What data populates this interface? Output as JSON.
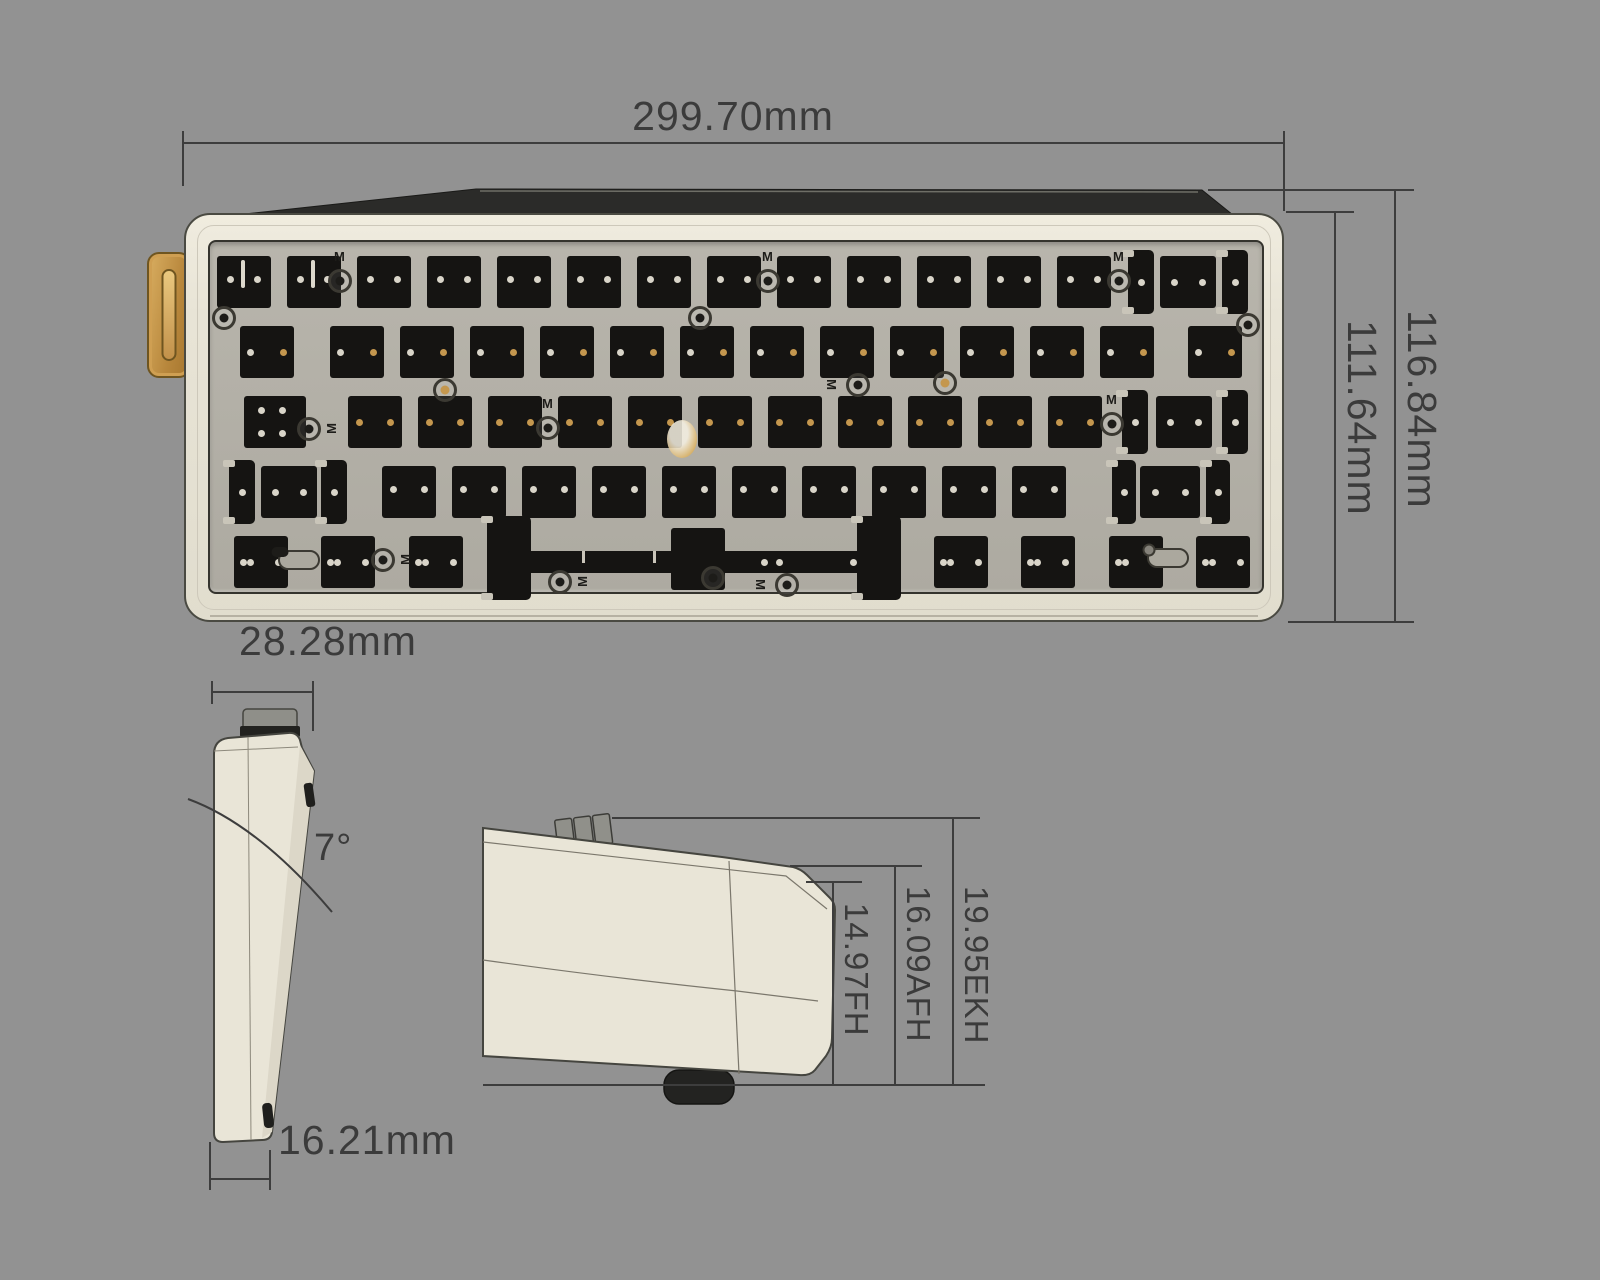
{
  "drawing": {
    "subject": "mechanical keyboard barebones kit dimension drawing",
    "views": [
      "top view",
      "side profile view",
      "front view"
    ]
  },
  "dimensions": {
    "top_width": "299.70mm",
    "case_depth_outer": "116.84mm",
    "case_depth_inner": "111.64mm",
    "side_top_depth": "28.28mm",
    "typing_angle": "7°",
    "side_front_height": "16.21mm",
    "front_height_fh": "14.97FH",
    "front_height_afh": "16.09AFH",
    "front_height_ekh": "19.95EKH"
  },
  "colors": {
    "background": "#929292",
    "case": "#e8e4d6",
    "plate": "#b2afa6",
    "cutout": "#151412",
    "accent_gold": "#c4974e",
    "line": "#3d3d3d",
    "text": "#3b3b3b"
  },
  "keyboard_layout": {
    "rows": [
      {
        "name": "r1",
        "y": 256,
        "h": 52,
        "dots": "r1",
        "plain": {
          "w": 54,
          "xs": [
            217,
            287,
            357,
            427,
            497,
            567,
            637,
            707,
            777,
            847,
            917,
            987,
            1057
          ]
        },
        "complex": [
          {
            "wings": [
              [
                1128,
                26
              ],
              [
                1222,
                26
              ]
            ],
            "sq": [
              1160,
              56
            ]
          }
        ]
      },
      {
        "name": "r2",
        "y": 326,
        "h": 52,
        "dots": "r2",
        "plain": {
          "w": 54,
          "xs": [
            240,
            330,
            400,
            470,
            540,
            610,
            680,
            750,
            820,
            890,
            960,
            1030,
            1100,
            1188
          ]
        }
      },
      {
        "name": "r3",
        "y": 396,
        "h": 52,
        "dots": "r3",
        "caps": {
          "x": 244,
          "w": 62
        },
        "plain": {
          "w": 54,
          "xs": [
            348,
            418,
            488,
            558,
            628,
            698,
            768,
            838,
            908,
            978,
            1048
          ]
        },
        "complex": [
          {
            "wings": [
              [
                1122,
                26
              ],
              [
                1222,
                26
              ]
            ],
            "sq": [
              1156,
              56
            ]
          }
        ]
      },
      {
        "name": "r4",
        "y": 466,
        "h": 52,
        "dots": "r4",
        "plain": {
          "w": 54,
          "xs": [
            382,
            452,
            522,
            592,
            662,
            732,
            802,
            872,
            942,
            1012
          ]
        },
        "complex": [
          {
            "wings": [
              [
                229,
                26
              ],
              [
                321,
                26
              ]
            ],
            "sq": [
              261,
              56
            ]
          },
          {
            "wings": [
              [
                1112,
                24
              ],
              [
                1206,
                24
              ]
            ],
            "sq": [
              1140,
              60
            ]
          }
        ]
      },
      {
        "name": "r5",
        "y": 536,
        "h": 52,
        "dots": "r5",
        "plain": {
          "w": 54,
          "xs": [
            234,
            321,
            409,
            934,
            1021,
            1109,
            1196
          ]
        },
        "space": {
          "stabs": [
            [
              487,
              44
            ],
            [
              857,
              44
            ]
          ],
          "stabY": 516,
          "stabH": 84,
          "bar": [
            508,
            372
          ],
          "barY": 551,
          "barH": 22,
          "sq": [
            671,
            54
          ],
          "sqY": 528,
          "sqH": 62
        }
      }
    ],
    "rings": [
      {
        "x": 224,
        "y": 318
      },
      {
        "x": 700,
        "y": 318
      },
      {
        "x": 1248,
        "y": 325
      },
      {
        "x": 340,
        "y": 281,
        "m": "t"
      },
      {
        "x": 768,
        "y": 281,
        "m": "t"
      },
      {
        "x": 1119,
        "y": 281,
        "m": "t"
      },
      {
        "x": 445,
        "y": 390,
        "gold": true
      },
      {
        "x": 858,
        "y": 385,
        "m": "l"
      },
      {
        "x": 945,
        "y": 383,
        "gold": true
      },
      {
        "x": 309,
        "y": 429,
        "m": "r"
      },
      {
        "x": 548,
        "y": 428,
        "m": "t"
      },
      {
        "x": 1112,
        "y": 424,
        "m": "t"
      },
      {
        "x": 383,
        "y": 560,
        "m": "r"
      },
      {
        "x": 560,
        "y": 582,
        "m": "r"
      },
      {
        "x": 713,
        "y": 578
      },
      {
        "x": 787,
        "y": 585,
        "m": "l"
      }
    ],
    "slots": [
      {
        "x": 299,
        "y": 560,
        "style": "oval"
      },
      {
        "x": 1168,
        "y": 558,
        "style": "ring"
      }
    ],
    "streaks": [
      {
        "x": 241,
        "y": 260
      },
      {
        "x": 311,
        "y": 260
      }
    ],
    "glare": {
      "x": 667,
      "y": 420,
      "w": 30,
      "h": 38
    },
    "marker_letter": "M"
  }
}
